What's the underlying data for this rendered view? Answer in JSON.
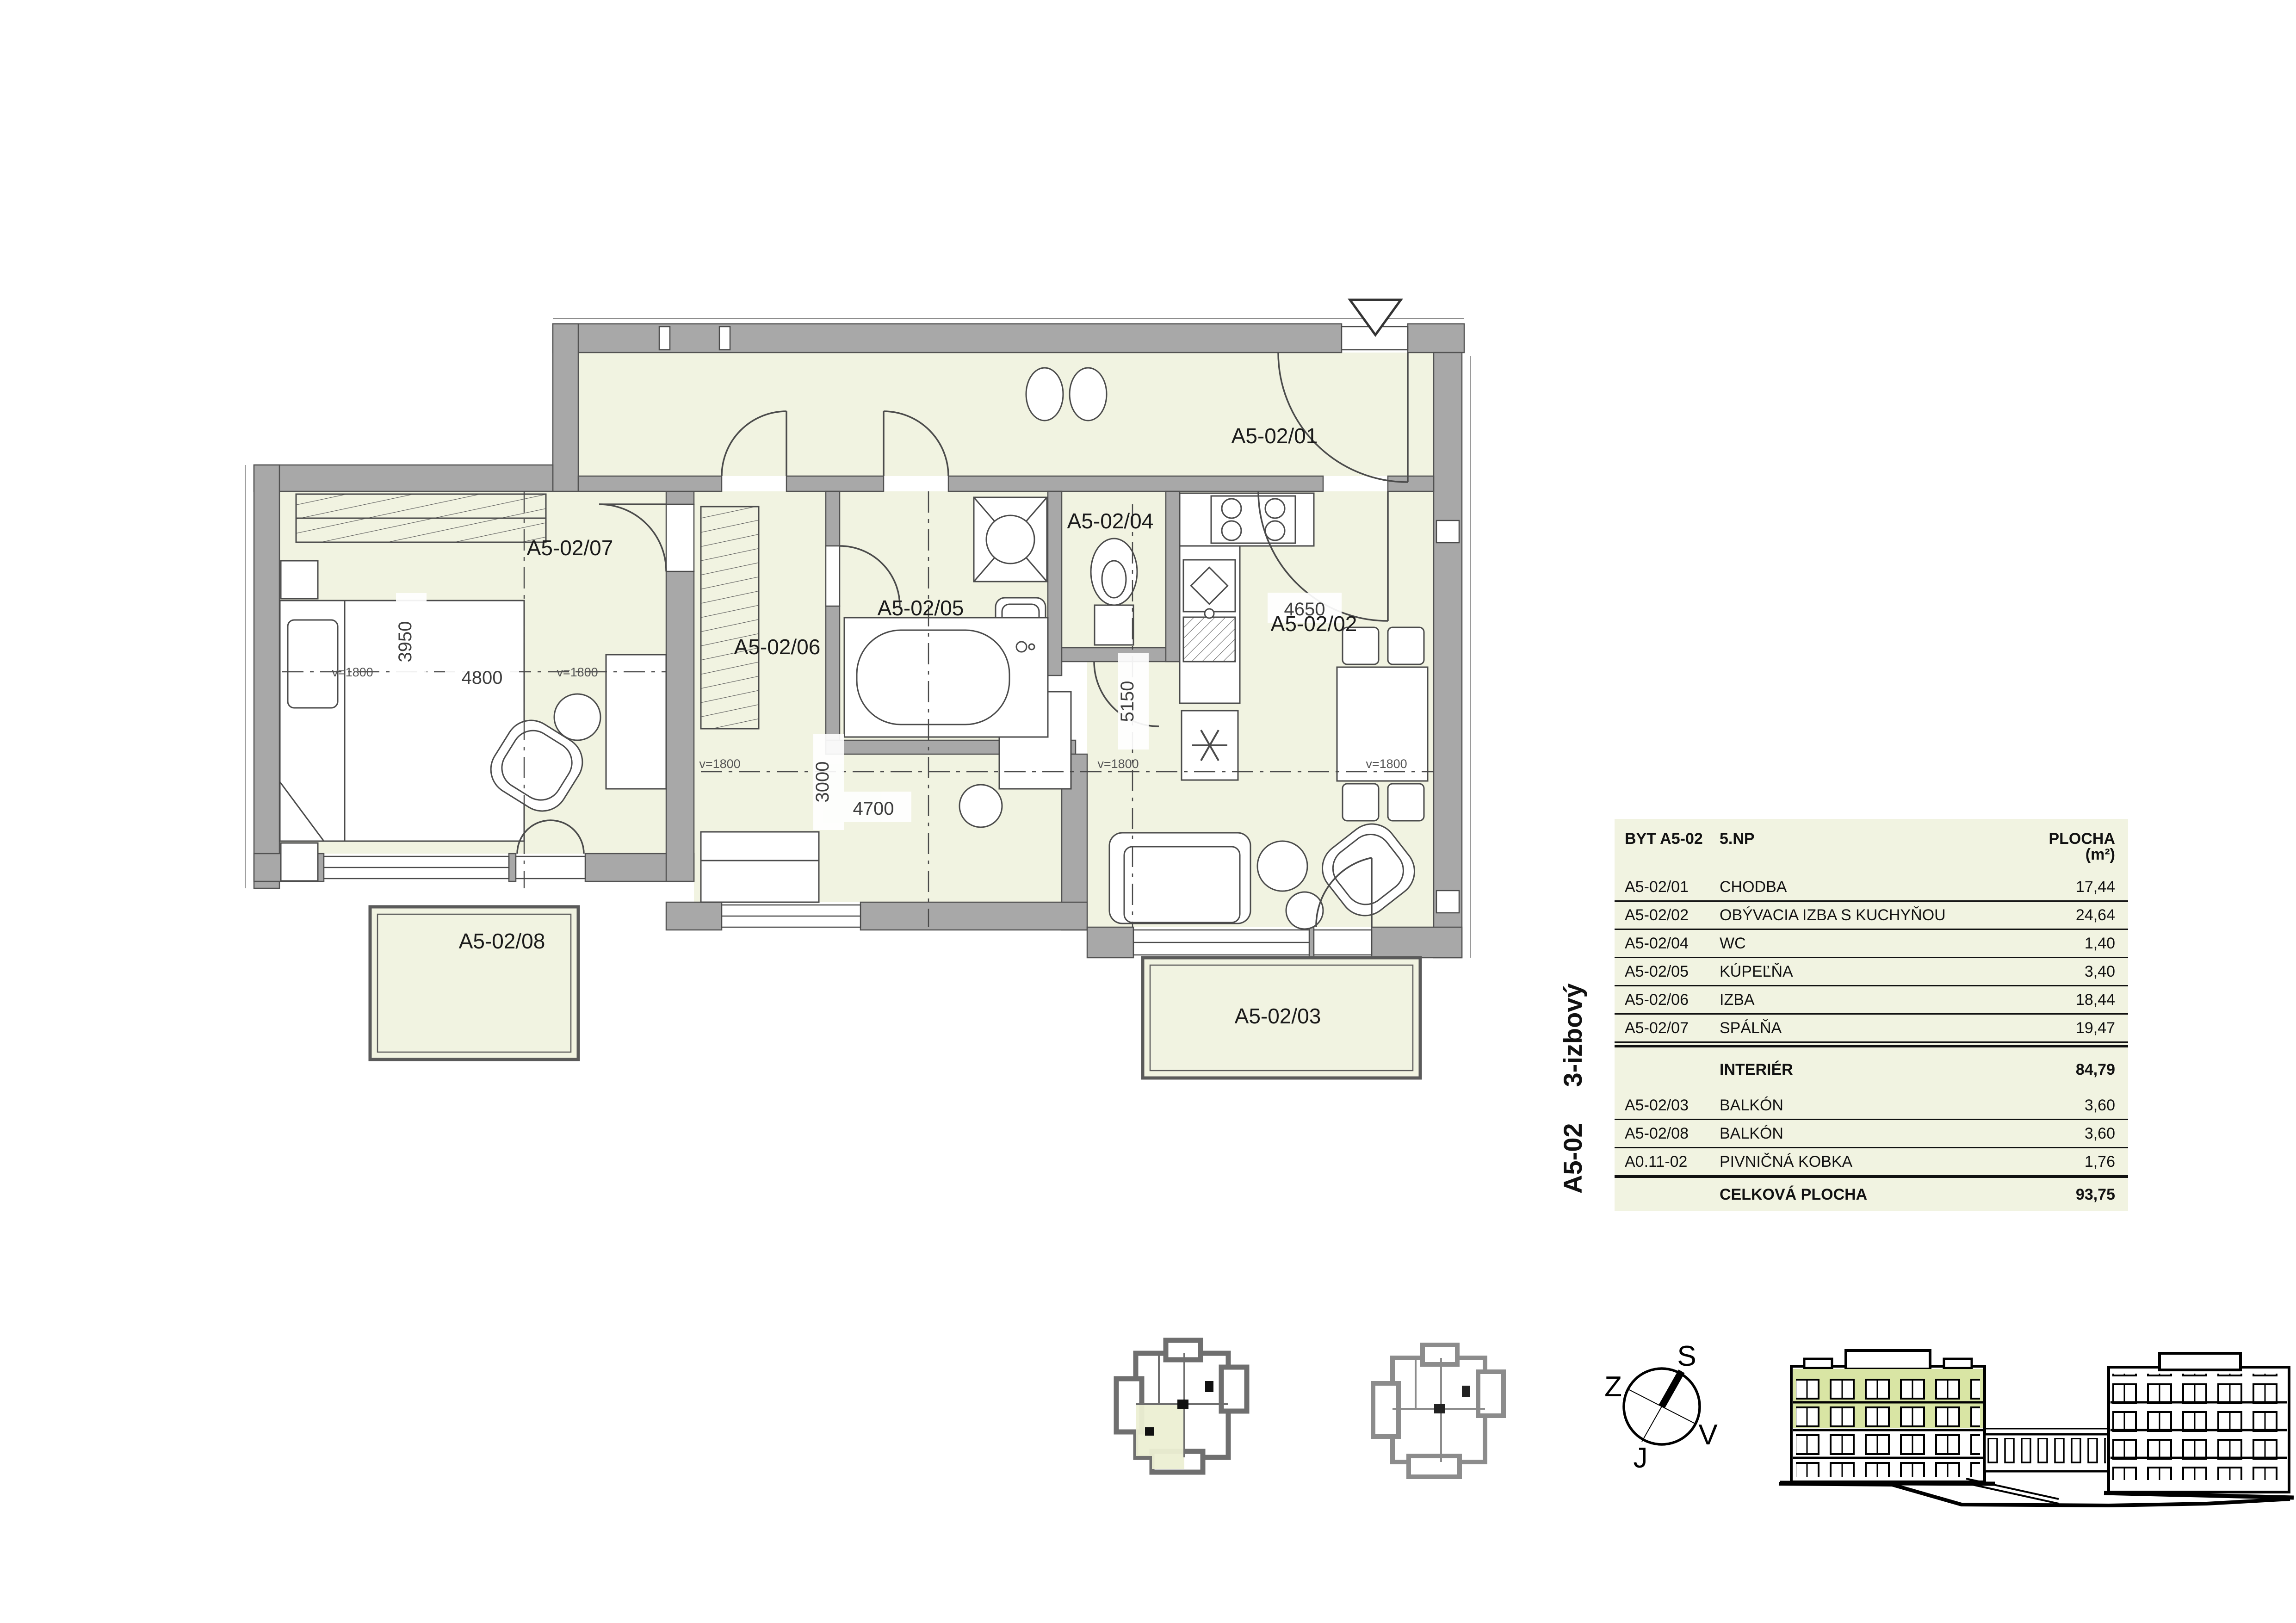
{
  "side_label": {
    "unit": "A5-02",
    "type": "3-izbový"
  },
  "table": {
    "header": {
      "unit": "BYT A5-02",
      "floor": "5.NP",
      "area": "PLOCHA (m²)"
    },
    "rows": [
      {
        "code": "A5-02/01",
        "name": "CHODBA",
        "area": "17,44"
      },
      {
        "code": "A5-02/02",
        "name": "OBÝVACIA IZBA S KUCHYŇOU",
        "area": "24,64"
      },
      {
        "code": "A5-02/04",
        "name": "WC",
        "area": "1,40"
      },
      {
        "code": "A5-02/05",
        "name": "KÚPEĽŇA",
        "area": "3,40"
      },
      {
        "code": "A5-02/06",
        "name": "IZBA",
        "area": "18,44"
      },
      {
        "code": "A5-02/07",
        "name": "SPÁLŇA",
        "area": "19,47"
      },
      {
        "code": "",
        "name": "INTERIÉR",
        "area": "84,79"
      },
      {
        "code": "A5-02/03",
        "name": "BALKÓN",
        "area": "3,60"
      },
      {
        "code": "A5-02/08",
        "name": "BALKÓN",
        "area": "3,60"
      },
      {
        "code": "A0.11-02",
        "name": "PIVNIČNÁ KOBKA",
        "area": "1,76"
      },
      {
        "code": "",
        "name": "CELKOVÁ PLOCHA",
        "area": "93,75"
      }
    ]
  },
  "plan": {
    "rooms": {
      "hall": "A5-02/01",
      "living": "A5-02/02",
      "balcony_bottom": "A5-02/03",
      "wc": "A5-02/04",
      "bath": "A5-02/05",
      "room": "A5-02/06",
      "bedroom": "A5-02/07",
      "balcony_left": "A5-02/08"
    },
    "dims": {
      "bedroom_w": "4800",
      "bedroom_d": "3950",
      "izba_w": "4700",
      "izba_d": "3000",
      "living_w": "4650",
      "living_d": "5150",
      "sill": "v=1800"
    }
  },
  "compass": {
    "n": "S",
    "w": "Z",
    "e": "V",
    "s": "J"
  },
  "colors": {
    "room_fill": "#f1f3e1",
    "wall": "#a8a8a8",
    "highlight": "#d9e5a4"
  }
}
